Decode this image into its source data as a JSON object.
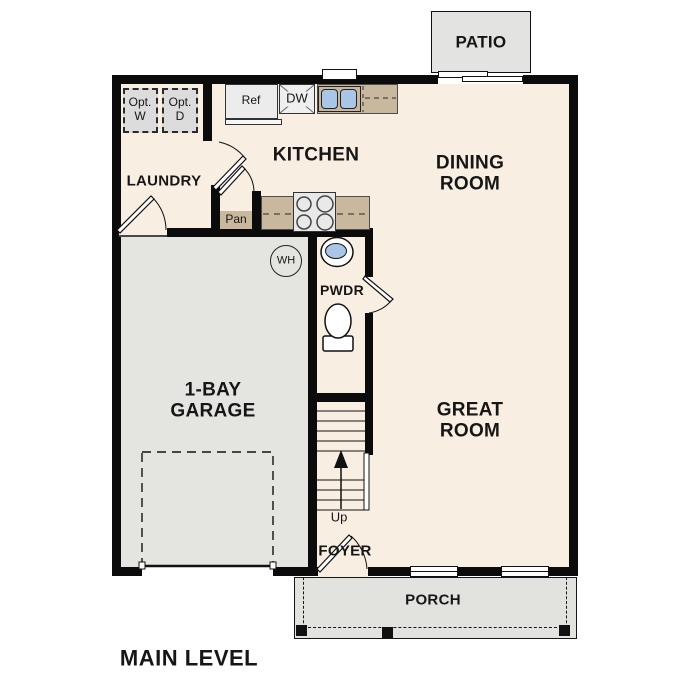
{
  "plan_title": "MAIN LEVEL",
  "rooms": {
    "patio": "PATIO",
    "kitchen": "KITCHEN",
    "dining_l1": "DINING",
    "dining_l2": "ROOM",
    "laundry": "LAUNDRY",
    "great_l1": "GREAT",
    "great_l2": "ROOM",
    "garage_l1": "1-BAY",
    "garage_l2": "GARAGE",
    "pwdr": "PWDR",
    "foyer": "FOYER",
    "porch": "PORCH"
  },
  "fixtures": {
    "opt_w_l1": "Opt.",
    "opt_w_l2": "W",
    "opt_d_l1": "Opt.",
    "opt_d_l2": "D",
    "refrigerator": "Ref",
    "dishwasher": "DW",
    "pantry": "Pan",
    "water_heater": "WH",
    "stairs_direction": "Up"
  },
  "colors": {
    "floor_cream": "#f8efe2",
    "garage_gray": "#e4e4e1",
    "porch_gray": "#e2e2df",
    "counter_tan": "#c9b89d",
    "sink_blue": "#a9c6e6",
    "wall_black": "#0b0b0b",
    "optional_appliance_gray": "#dcdcdc"
  }
}
